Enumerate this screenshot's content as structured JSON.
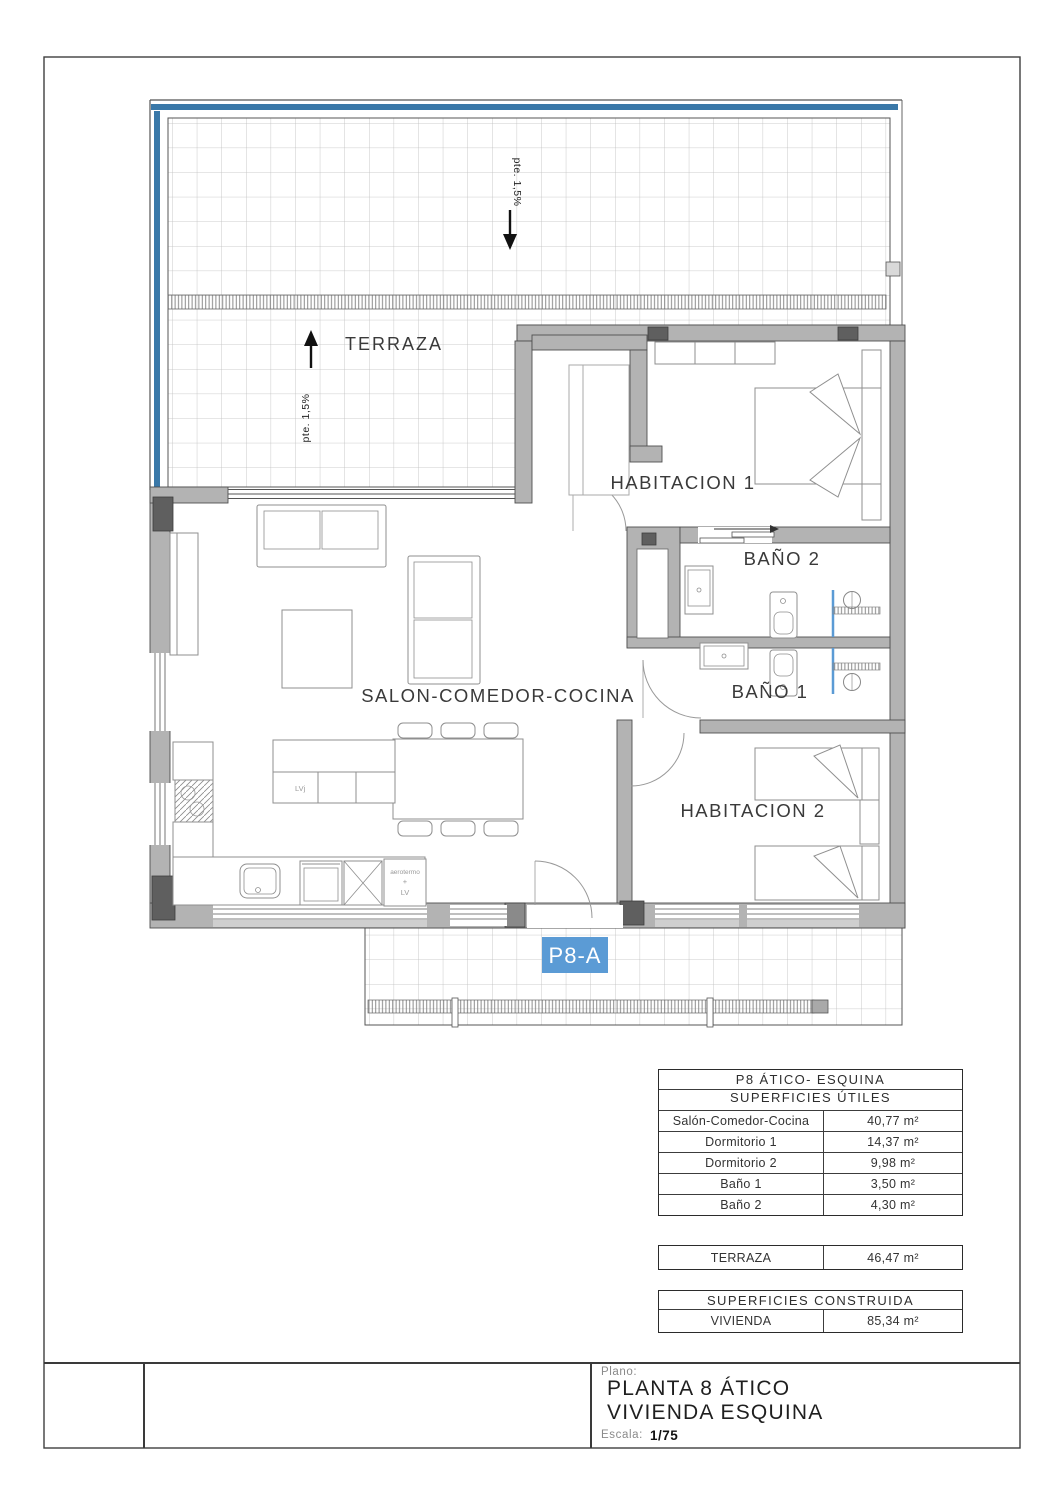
{
  "plan": {
    "terrace_label": "TERRAZA",
    "slope_label_top": "pte. 1,5%",
    "slope_label_left": "pte. 1,5%",
    "rooms": {
      "living": "SALON-COMEDOR-COCINA",
      "bedroom1": "HABITACION 1",
      "bedroom2": "HABITACION 2",
      "bath1": "BAÑO 1",
      "bath2": "BAÑO 2"
    },
    "unit_badge": "P8-A",
    "kitchen": {
      "island_label": "LVj",
      "aerotermo_line1": "aerotermo",
      "aerotermo_line2": "+",
      "aerotermo_line3": "LV"
    },
    "colors": {
      "accent_blue": "#3a78a8",
      "badge_blue": "#5b9bd5",
      "wall_gray": "#b3b3b3",
      "pillar_gray": "#5f5f5f"
    }
  },
  "tables": {
    "useful": {
      "title": "P8 ÁTICO- ESQUINA",
      "subtitle": "SUPERFICIES ÚTILES",
      "rows": [
        {
          "label": "Salón-Comedor-Cocina",
          "value": "40,77 m²"
        },
        {
          "label": "Dormitorio 1",
          "value": "14,37 m²"
        },
        {
          "label": "Dormitorio 2",
          "value": "9,98 m²"
        },
        {
          "label": "Baño 1",
          "value": "3,50 m²"
        },
        {
          "label": "Baño 2",
          "value": "4,30 m²"
        }
      ]
    },
    "terrace": {
      "label": "TERRAZA",
      "value": "46,47 m²"
    },
    "built": {
      "title": "SUPERFICIES CONSTRUIDA",
      "rows": [
        {
          "label": "VIVIENDA",
          "value": "85,34 m²"
        }
      ]
    }
  },
  "titleblock": {
    "plano_label": "Plano:",
    "title_line1": "PLANTA 8 ÁTICO",
    "title_line2": "VIVIENDA ESQUINA",
    "escala_label": "Escala:",
    "escala_value": "1/75"
  }
}
